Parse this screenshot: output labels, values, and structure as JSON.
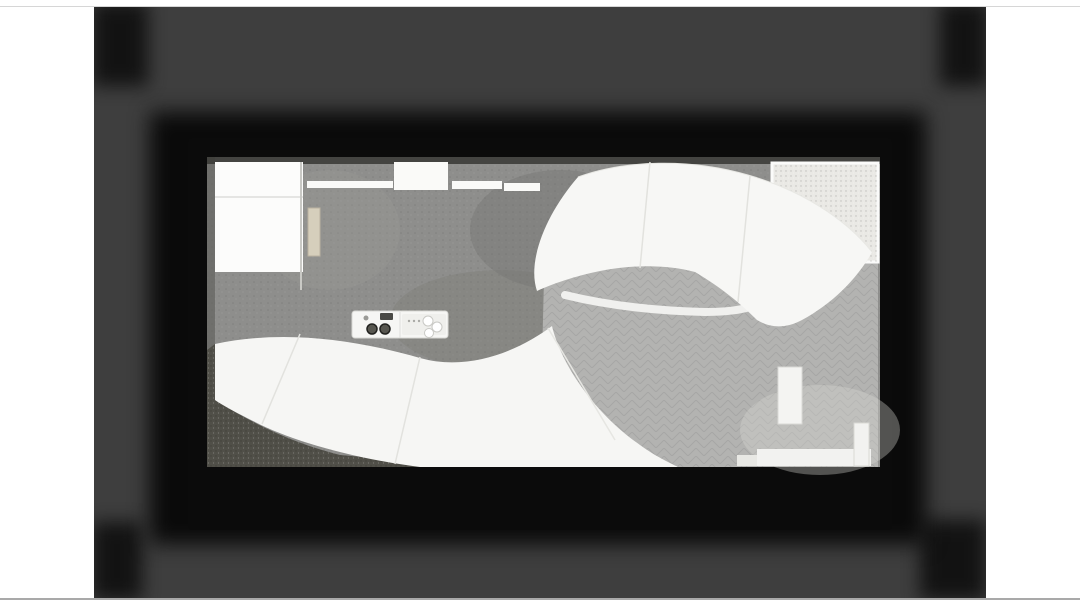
{
  "meta": {
    "title": "Top-down architectural rendering of a cafe interior and plaza with curved white canopies",
    "image_kind": "3d-render-slide"
  },
  "colors": {
    "page_bg": "#ffffff",
    "slide_bg": "#3e3e3e",
    "card_black": "#0a0a0a",
    "indoor_floor": "#8e8e8c",
    "plaza_floor": "#b3b3b1",
    "canopy_white": "#f7f7f5",
    "room_white": "#fcfcfb",
    "beam_white": "#fafaf8",
    "skylight_cell": "#4e463b",
    "mullion": "#f2f2f0",
    "gravel_bed": "#eae9e5",
    "gravel_dark": "#504f48",
    "chair": "#e8e4d6",
    "chair_edge": "#b9b5a6",
    "table_top": "#44443e",
    "wave_white": "#f3f3f1",
    "planter_circle": "#c7c7c5",
    "step_white": "#f2f2f0",
    "green_dark": "#33491f",
    "green_mid": "#4c6b28",
    "green_light": "#6d9334",
    "green_bright": "#8fb54b",
    "light_core": "#fffdf0",
    "light_glow": "#ffedb8"
  },
  "scene": {
    "skylight": {
      "x": 217,
      "y": 276,
      "w": 90,
      "h": 68,
      "cols": 5,
      "rows": 4
    },
    "tables": [
      {
        "x": 353,
        "y": 222
      },
      {
        "x": 417,
        "y": 221
      },
      {
        "x": 472,
        "y": 221
      },
      {
        "x": 350,
        "y": 276
      },
      {
        "x": 472,
        "y": 274
      }
    ],
    "waves": [
      {
        "d": "M 613,352 C 638,332 664,332 688,350 C 712,368 740,365 766,346",
        "w": 9
      },
      {
        "d": "M 612,398 C 638,376 666,378 692,399 C 716,419 744,414 768,392",
        "w": 12
      },
      {
        "d": "M 616,433 C 644,415 670,417 696,434 C 720,449 742,446 762,428",
        "w": 9
      }
    ],
    "planter_circles": [
      {
        "x": 691,
        "y": 377,
        "r": 12
      },
      {
        "x": 645,
        "y": 404,
        "r": 13
      },
      {
        "x": 731,
        "y": 404,
        "r": 12
      }
    ],
    "plants": [
      {
        "x": 797,
        "y": 177,
        "r": 12,
        "type": "bush",
        "tone": "dark"
      },
      {
        "x": 812,
        "y": 187,
        "r": 8,
        "type": "bush",
        "tone": "mid"
      },
      {
        "x": 845,
        "y": 198,
        "r": 19,
        "type": "bush",
        "tone": "bright"
      },
      {
        "x": 858,
        "y": 222,
        "r": 13,
        "type": "bush",
        "tone": "light"
      },
      {
        "x": 833,
        "y": 213,
        "r": 10,
        "type": "bush",
        "tone": "bright"
      },
      {
        "x": 328,
        "y": 330,
        "r": 13,
        "type": "bush",
        "tone": "mid"
      },
      {
        "x": 349,
        "y": 320,
        "r": 10,
        "type": "bush",
        "tone": "dark"
      },
      {
        "x": 608,
        "y": 297,
        "r": 21,
        "type": "palm",
        "tone": "dark"
      },
      {
        "x": 462,
        "y": 331,
        "r": 11,
        "type": "palm",
        "tone": "bright"
      },
      {
        "x": 789,
        "y": 379,
        "r": 8,
        "type": "bush",
        "tone": "dark"
      },
      {
        "x": 791,
        "y": 394,
        "r": 9,
        "type": "bush",
        "tone": "mid"
      },
      {
        "x": 793,
        "y": 409,
        "r": 8,
        "type": "bush",
        "tone": "dark"
      },
      {
        "x": 787,
        "y": 420,
        "r": 7,
        "type": "bush",
        "tone": "mid"
      },
      {
        "x": 540,
        "y": 448,
        "r": 10,
        "type": "bush",
        "tone": "dark"
      },
      {
        "x": 573,
        "y": 453,
        "r": 8,
        "type": "bush",
        "tone": "dark"
      }
    ],
    "bushes": [
      {
        "x": 220,
        "y": 420,
        "r": 15
      },
      {
        "x": 243,
        "y": 439,
        "r": 17
      },
      {
        "x": 268,
        "y": 454,
        "r": 15
      },
      {
        "x": 297,
        "y": 460,
        "r": 14
      },
      {
        "x": 322,
        "y": 462,
        "r": 11
      },
      {
        "x": 237,
        "y": 459,
        "r": 13
      },
      {
        "x": 214,
        "y": 447,
        "r": 11
      },
      {
        "x": 290,
        "y": 441,
        "r": 11
      },
      {
        "x": 318,
        "y": 449,
        "r": 9
      },
      {
        "x": 255,
        "y": 425,
        "r": 12
      }
    ],
    "hedge": {
      "x": 212,
      "y": 276,
      "w": 9,
      "h": 68
    },
    "ceiling_lights": [
      {
        "x": 327,
        "y": 171
      },
      {
        "x": 363,
        "y": 171
      },
      {
        "x": 410,
        "y": 172
      },
      {
        "x": 458,
        "y": 171
      },
      {
        "x": 502,
        "y": 171
      },
      {
        "x": 545,
        "y": 174
      },
      {
        "x": 577,
        "y": 176
      },
      {
        "x": 318,
        "y": 197
      },
      {
        "x": 363,
        "y": 197
      },
      {
        "x": 412,
        "y": 198
      },
      {
        "x": 460,
        "y": 197
      },
      {
        "x": 505,
        "y": 197
      },
      {
        "x": 548,
        "y": 199
      },
      {
        "x": 332,
        "y": 217
      },
      {
        "x": 527,
        "y": 217
      },
      {
        "x": 312,
        "y": 246
      },
      {
        "x": 352,
        "y": 246
      },
      {
        "x": 420,
        "y": 247
      },
      {
        "x": 472,
        "y": 247
      },
      {
        "x": 332,
        "y": 281
      },
      {
        "x": 390,
        "y": 265
      },
      {
        "x": 477,
        "y": 265
      },
      {
        "x": 528,
        "y": 282
      },
      {
        "x": 583,
        "y": 256
      },
      {
        "x": 362,
        "y": 300
      },
      {
        "x": 420,
        "y": 301
      },
      {
        "x": 480,
        "y": 300
      },
      {
        "x": 530,
        "y": 300
      }
    ],
    "plaza_lights": [
      {
        "x": 575,
        "y": 362
      },
      {
        "x": 642,
        "y": 330
      },
      {
        "x": 740,
        "y": 367
      },
      {
        "x": 585,
        "y": 427
      },
      {
        "x": 697,
        "y": 430
      }
    ],
    "skylight_lights": [
      {
        "x": 295,
        "y": 281
      },
      {
        "x": 231,
        "y": 318
      },
      {
        "x": 277,
        "y": 329
      },
      {
        "x": 240,
        "y": 342
      }
    ],
    "gravel_lights": [
      {
        "x": 232,
        "y": 437
      }
    ],
    "edge_lights_bottom": [
      {
        "x": 717,
        "y": 472
      },
      {
        "x": 739,
        "y": 472
      },
      {
        "x": 760,
        "y": 472
      },
      {
        "x": 781,
        "y": 472
      },
      {
        "x": 804,
        "y": 472
      },
      {
        "x": 822,
        "y": 472
      },
      {
        "x": 840,
        "y": 472
      },
      {
        "x": 856,
        "y": 472
      }
    ],
    "edge_lights_right": [
      {
        "x": 877,
        "y": 368
      },
      {
        "x": 877,
        "y": 385
      },
      {
        "x": 877,
        "y": 402
      },
      {
        "x": 877,
        "y": 419
      },
      {
        "x": 877,
        "y": 437
      },
      {
        "x": 877,
        "y": 455
      }
    ],
    "dim_lights": [
      {
        "x": 322,
        "y": 477
      },
      {
        "x": 368,
        "y": 478
      },
      {
        "x": 426,
        "y": 478
      },
      {
        "x": 490,
        "y": 477
      },
      {
        "x": 553,
        "y": 476
      }
    ],
    "white_dashes": [
      {
        "x": 240,
        "y": 489,
        "w": 13,
        "h": 4
      },
      {
        "x": 258,
        "y": 489,
        "w": 10,
        "h": 4
      }
    ]
  }
}
